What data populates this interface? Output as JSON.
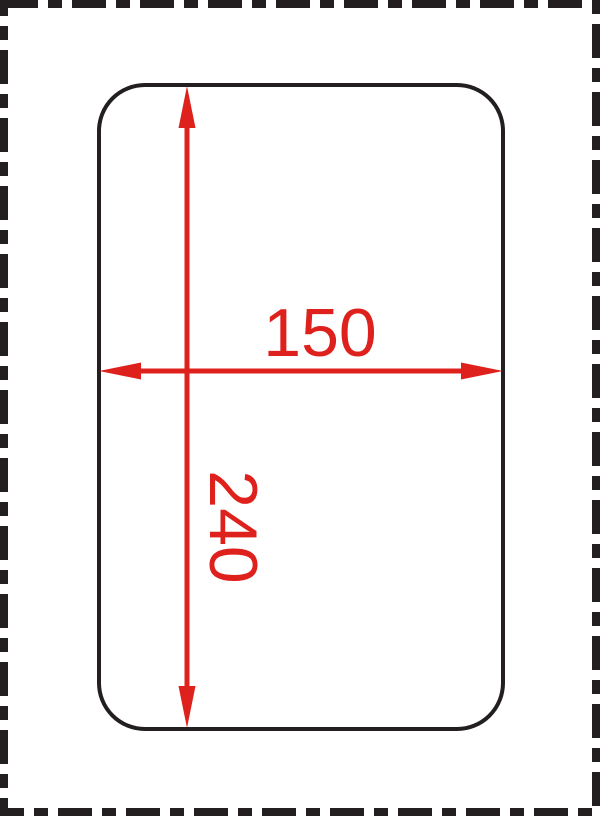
{
  "page": {
    "background_color": "#ffffff",
    "border": {
      "style": "dash-dot",
      "color": "#231f20"
    }
  },
  "drawing": {
    "shape": "rounded-rectangle",
    "outline_color": "#231f20",
    "dimension_color": "#de211c",
    "width_dimension": {
      "label": "150",
      "orientation": "horizontal"
    },
    "height_dimension": {
      "label": "240",
      "orientation": "vertical"
    }
  }
}
